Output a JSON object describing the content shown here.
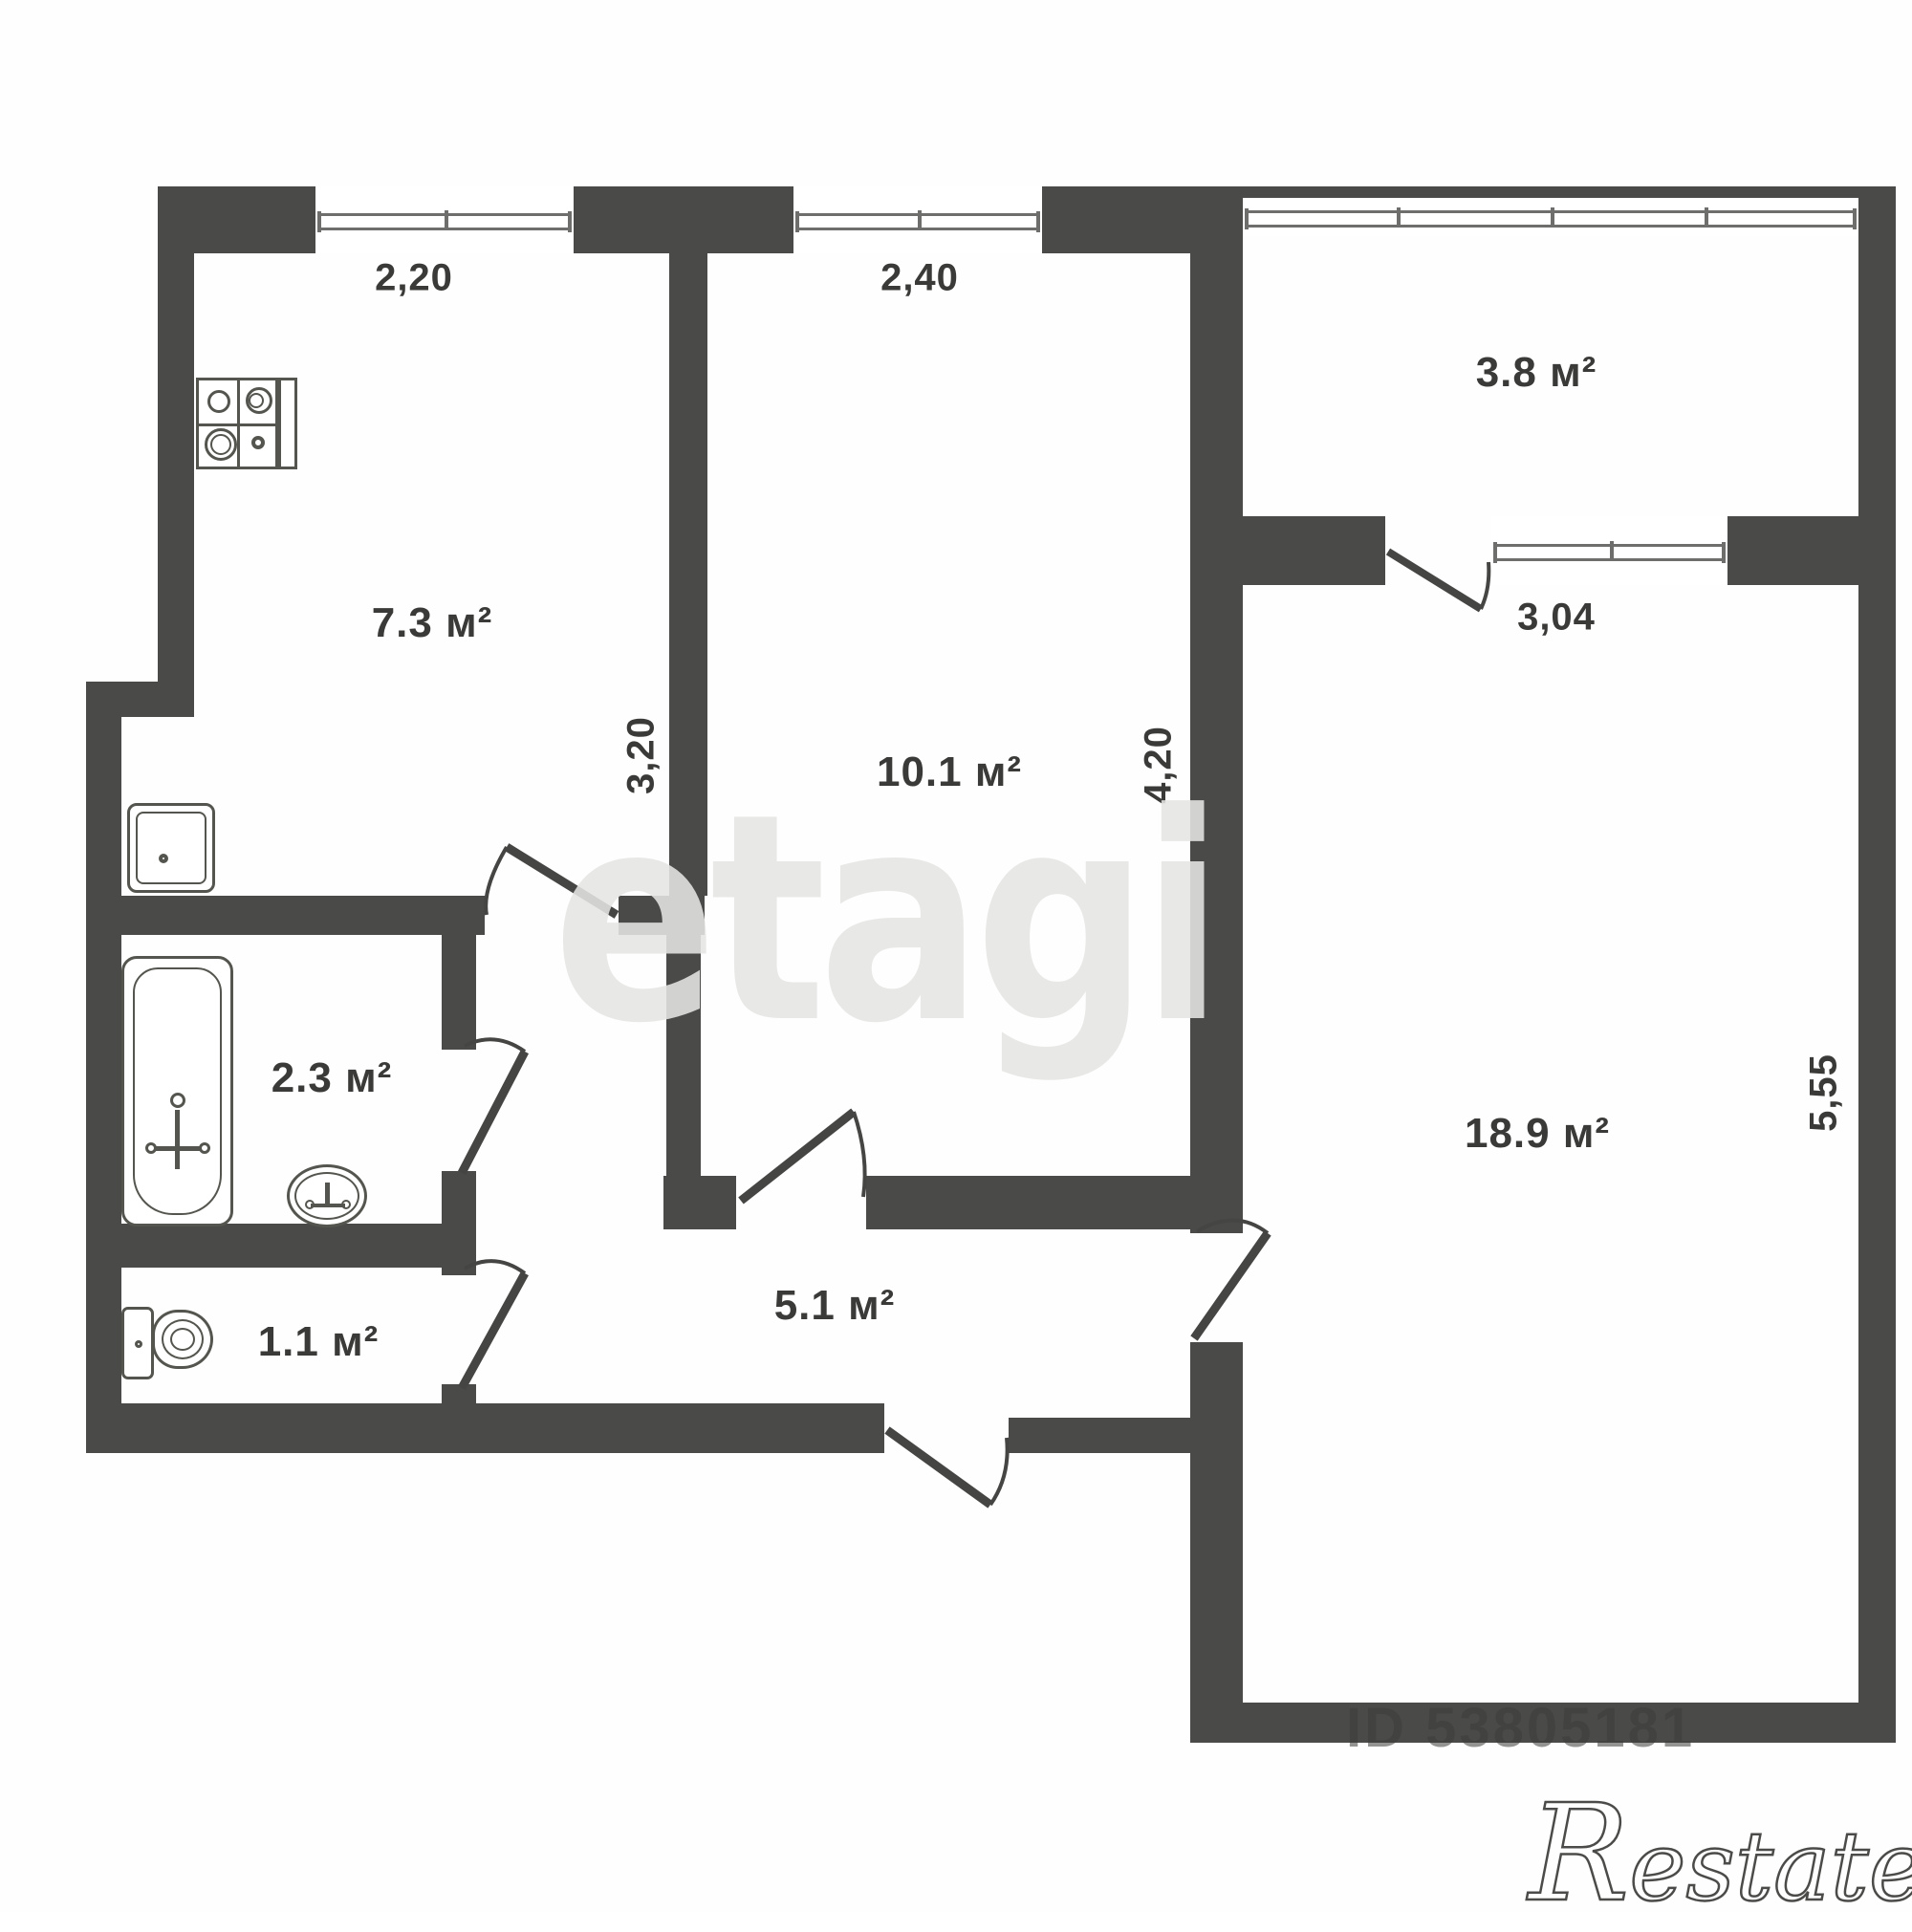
{
  "plan": {
    "rooms": [
      {
        "id": "kitchen",
        "area_label": "7.3 м²"
      },
      {
        "id": "room",
        "area_label": "10.1 м²"
      },
      {
        "id": "balcony",
        "area_label": "3.8 м²"
      },
      {
        "id": "bathroom",
        "area_label": "2.3 м²"
      },
      {
        "id": "toilet",
        "area_label": "1.1 м²"
      },
      {
        "id": "hallway",
        "area_label": "5.1 м²"
      },
      {
        "id": "living-room",
        "area_label": "18.9 м²"
      }
    ],
    "dimensions": {
      "kitchen_window_width": "2,20",
      "room_window_width": "2,40",
      "balcony_window_width": "3,04",
      "kitchen_depth": "3,20",
      "room_depth": "4,20",
      "living_room_depth": "5,55"
    },
    "colors": {
      "wall": "#4a4a48",
      "label_text": "#3a3a38",
      "window_line": "#6e6e6c",
      "watermark_gray": "#e5e5e3"
    }
  },
  "watermarks": {
    "brand": "etagi",
    "listing_id": "ID 53805181",
    "agency_logo": "Restate"
  }
}
